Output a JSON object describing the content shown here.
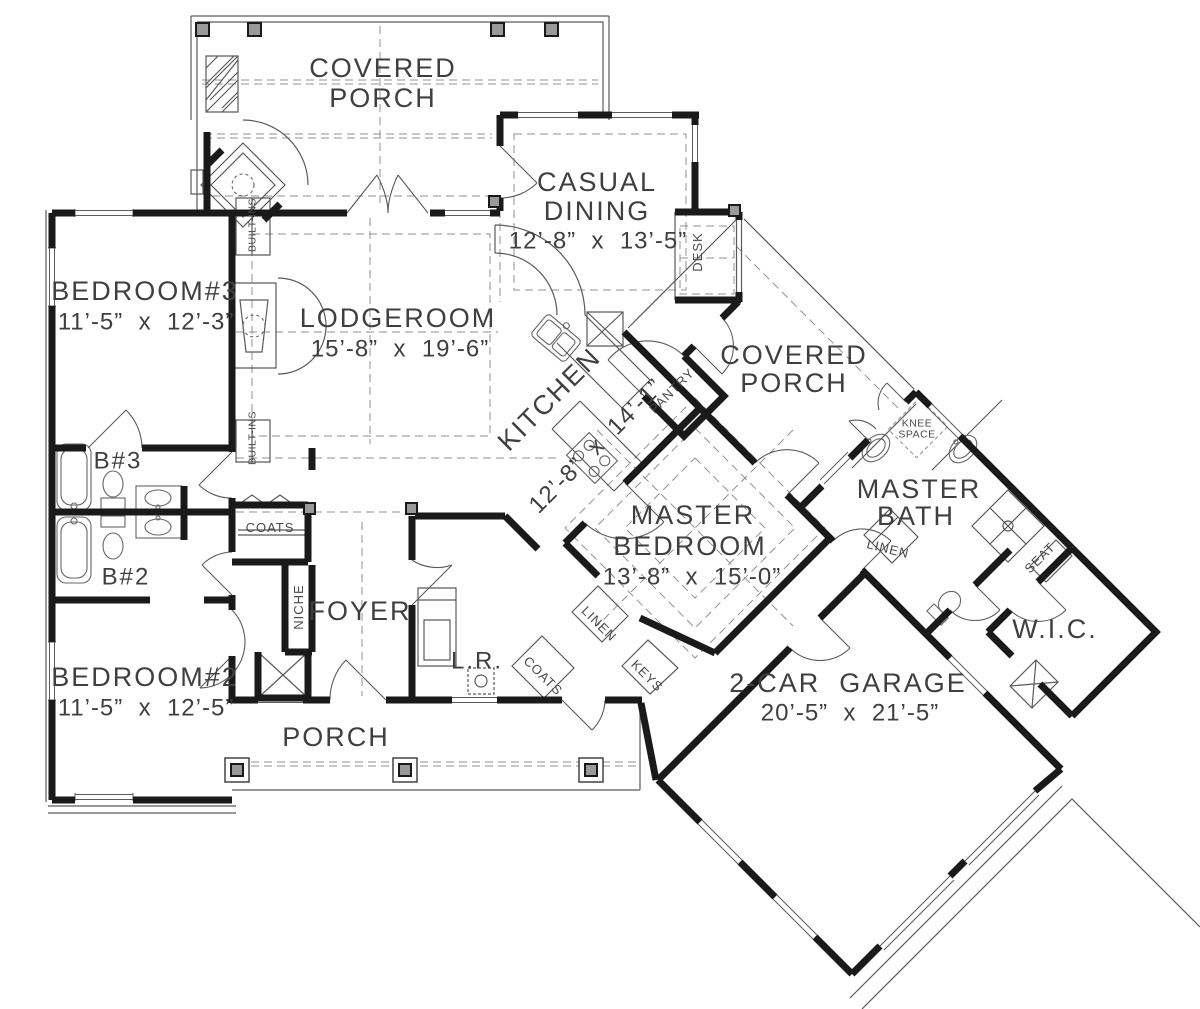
{
  "plan": {
    "rooms": {
      "covered_porch_top": {
        "l1": "COVERED",
        "l2": "PORCH"
      },
      "casual_dining": {
        "l1": "CASUAL",
        "l2": "DINING",
        "dims": "12’-8”  x  13’-5”"
      },
      "bedroom_3": {
        "l1": "BEDROOM#3",
        "dims": "11’-5”  x  12’-3”"
      },
      "lodgeroom": {
        "l1": "LODGEROOM",
        "dims": "15’-8”  x  19’-6”"
      },
      "kitchen": {
        "l1": "KITCHEN",
        "dims": "12’-8”  x  14’-1”"
      },
      "covered_porch_right": {
        "l1": "COVERED",
        "l2": "PORCH"
      },
      "master_bath": {
        "l1": "MASTER",
        "l2": "BATH"
      },
      "master_bedroom": {
        "l1": "MASTER",
        "l2": "BEDROOM",
        "dims": "13’-8”  x  15’-0”"
      },
      "wic": {
        "l1": "W.I.C."
      },
      "garage": {
        "l1": "2-CAR  GARAGE",
        "dims": "20’-5”  x  21’-5”"
      },
      "bedroom_2": {
        "l1": "BEDROOM#2",
        "dims": "11’-5”  x  12’-5”"
      },
      "bath_3": {
        "l1": "B#3"
      },
      "bath_2": {
        "l1": "B#2"
      },
      "foyer": {
        "l1": "FOYER"
      },
      "laundry": {
        "l1": "L.R."
      },
      "porch": {
        "l1": "PORCH"
      }
    },
    "labels": {
      "desk": "DESK",
      "pantry": "PANTRY",
      "built_ins_upper": "BUILT-INS",
      "built_ins_lower": "BUILT-INS",
      "knee_space_l1": "KNEE",
      "knee_space_l2": "SPACE",
      "linen_master_bath": "LINEN",
      "linen_hall": "LINEN",
      "keys": "KEYS",
      "seat": "SEAT",
      "coats_foyer": "COATS",
      "coats_hall": "COATS",
      "niche": "NICHE"
    },
    "colors": {
      "wall": "#1a1a1a",
      "thin_line": "#5a5a5a",
      "dashed_line": "#909090",
      "post_fill": "#999999",
      "text": "#3f3f3f",
      "background": "#ffffff"
    }
  }
}
